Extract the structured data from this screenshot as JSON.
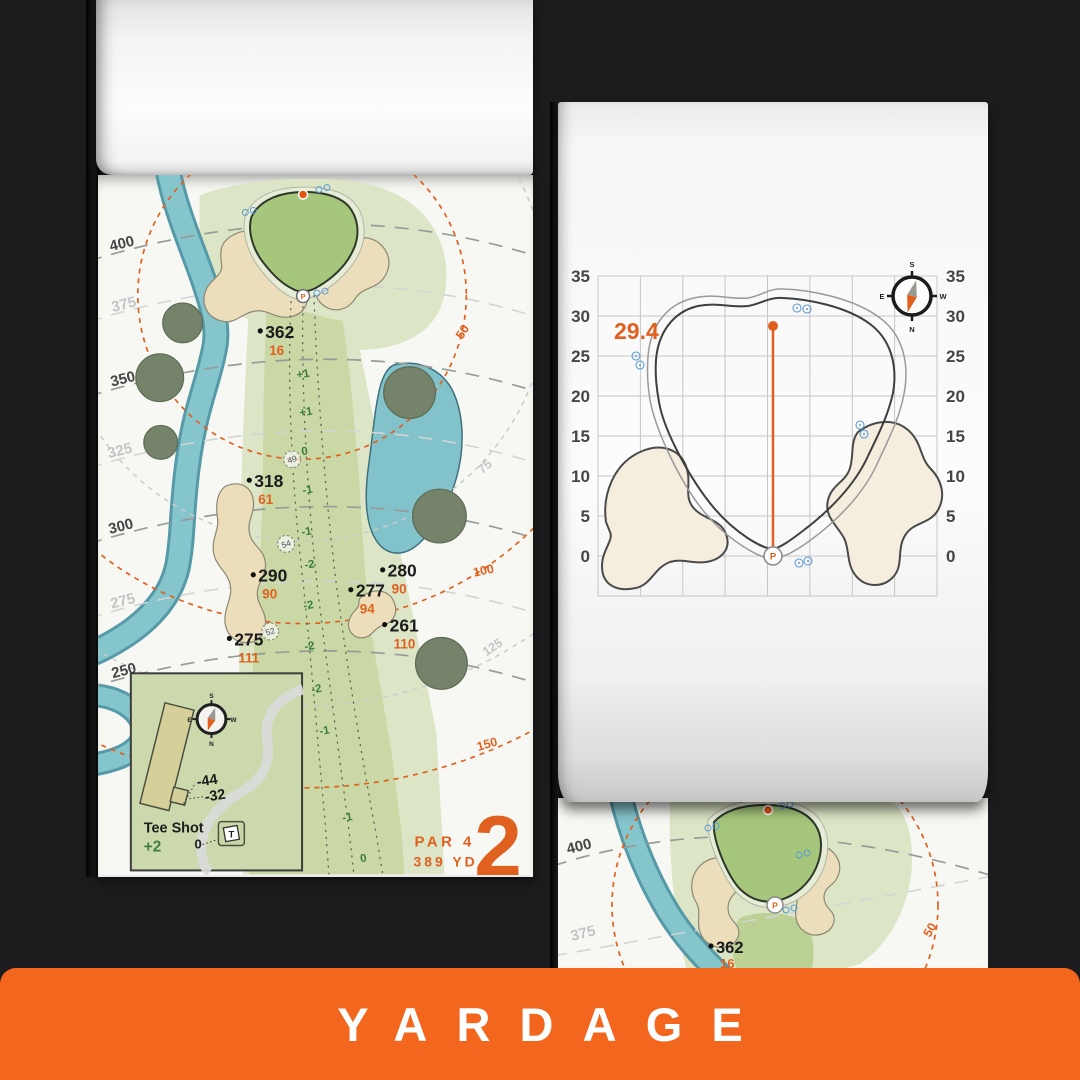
{
  "banner": {
    "label": "YARDAGE",
    "bg_color": "#f2671d",
    "text_color": "#ffffff"
  },
  "colors": {
    "accent_orange": "#e0611f",
    "elevation_green": "#3c7d3a",
    "water": "#7fc0c9",
    "sand": "#ecdeba",
    "fairway": "#c9d8a4",
    "rough": "#dce5c6",
    "putting_green": "#a6c67c",
    "tree": "#75836b",
    "grid_gray": "#c6c6c6",
    "background": "#1c1c1e"
  },
  "left_page": {
    "distance_labels": [
      "400",
      "375",
      "350",
      "325",
      "300",
      "275",
      "250"
    ],
    "arc_labels": [
      "50",
      "75",
      "100",
      "125",
      "150"
    ],
    "yardage_points": [
      {
        "carry": "362",
        "front": "16"
      },
      {
        "carry": "318",
        "front": "61"
      },
      {
        "carry": "290",
        "front": "90"
      },
      {
        "carry": "280",
        "front": "90"
      },
      {
        "carry": "277",
        "front": "94"
      },
      {
        "carry": "261",
        "front": "110"
      },
      {
        "carry": "275",
        "front": "111"
      }
    ],
    "sprinklers": [
      "49",
      "54",
      "52"
    ],
    "elevations": [
      "+1",
      "+1",
      "0",
      "-1",
      "-1",
      "-2",
      "-2",
      "-2",
      "-2",
      "-1",
      "-1",
      "0"
    ],
    "pin_label": "P",
    "hole": {
      "par": "PAR 4",
      "yards": "389 YD",
      "number": "2"
    },
    "tee_inset": {
      "title": "Tee Shot",
      "elevation": "+2",
      "zero": "0",
      "tee_marker": "T",
      "far": "-44",
      "near": "-32"
    }
  },
  "right_page": {
    "depth_label": "29.4",
    "axis_ticks": [
      "35",
      "30",
      "25",
      "20",
      "15",
      "10",
      "5",
      "0"
    ],
    "pin_label": "P"
  },
  "preview_page": {
    "distance_labels": [
      "400",
      "375"
    ],
    "arc_label": "50",
    "yardage": {
      "carry": "362",
      "front": "16"
    }
  },
  "compass": {
    "top": "S",
    "right": "W",
    "bottom": "N",
    "left": "E"
  }
}
